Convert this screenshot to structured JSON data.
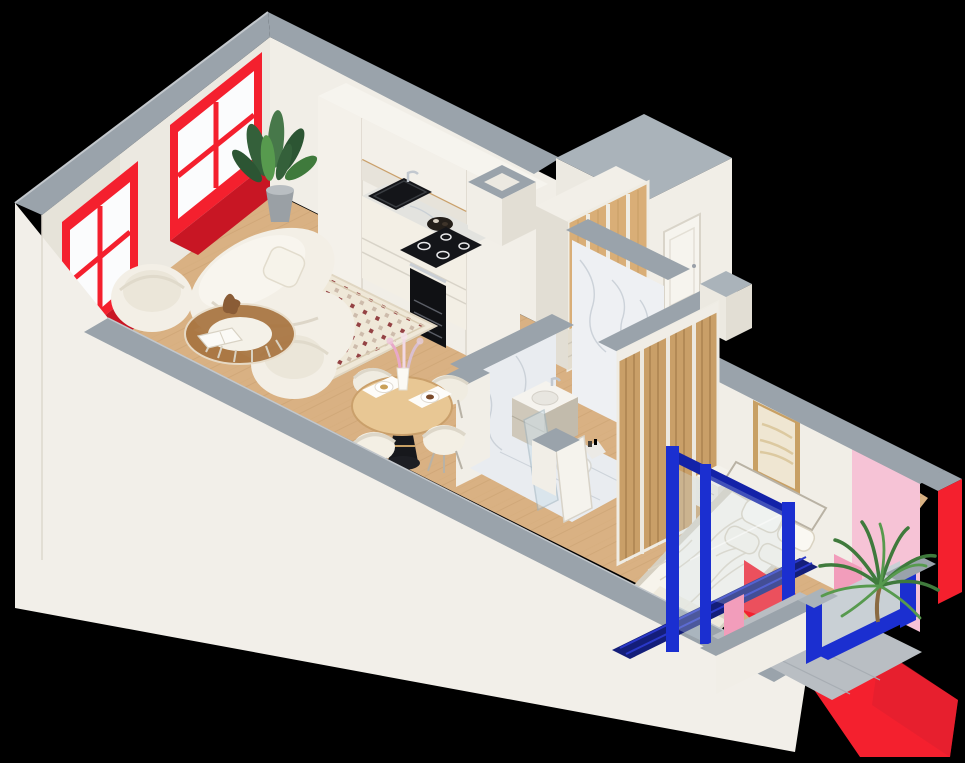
{
  "image": {
    "width": 965,
    "height": 763,
    "kind": "isometric-3d-apartment-floor-plan",
    "background": "#000000"
  },
  "colors": {
    "black": "#000000",
    "grayTop": "#9aa3ab",
    "grayTopLight": "#aab3ba",
    "wallWhite": "#f1eee7",
    "wallCream": "#ece9e1",
    "wallShade": "#e2ded4",
    "skirt": "#f2efe9",
    "red": "#f4202e",
    "redDeep": "#c81624",
    "blue": "#1b2fd0",
    "blueDeep": "#141e7a",
    "pink": "#f6c3d6",
    "pinkDeep": "#f29dbb",
    "cane": "#d9ae77",
    "woodSlat": "#c99f68",
    "floorWood": "#d9b183",
    "floorLine": "#b98f5e",
    "marble": "#eef0f3",
    "marbleVein": "#c6ccd4",
    "bathFloor": "#e9ecf0",
    "concrete": "#b9bec3",
    "cream": "#f3efe5",
    "creamShade": "#e3ddcf",
    "appliance": "#141519",
    "steel": "#c2c8cf",
    "gold": "#c8a064",
    "artBeige": "#efe6d2",
    "green": "#3f7a3c",
    "greenLight": "#579a4e",
    "greenDark": "#2c5533",
    "taupe": "#cfc8ba",
    "glass": "#cfe0ea",
    "tableWood": "#e8c794",
    "amber": "#a8743f"
  },
  "scene": {
    "rooms": [
      "living-room",
      "kitchen",
      "entry-hall",
      "bathroom",
      "bedroom",
      "balcony"
    ],
    "objects": [
      "red-frame-window-left",
      "red-frame-window-right",
      "potted-plant",
      "kitchen-cabinets",
      "sink",
      "cooktop",
      "oven",
      "sofa",
      "armchair",
      "coffee-table",
      "rug",
      "dining-table",
      "dining-chairs",
      "hall-wardrobe",
      "entrance-door",
      "bathroom-vanity",
      "toilet",
      "shower-glass-door",
      "bedroom-wardrobe",
      "bed",
      "nightstand",
      "wall-artwork",
      "pink-accent-wall",
      "blue-sliding-door",
      "balcony-blue-window",
      "palm-plant"
    ]
  }
}
